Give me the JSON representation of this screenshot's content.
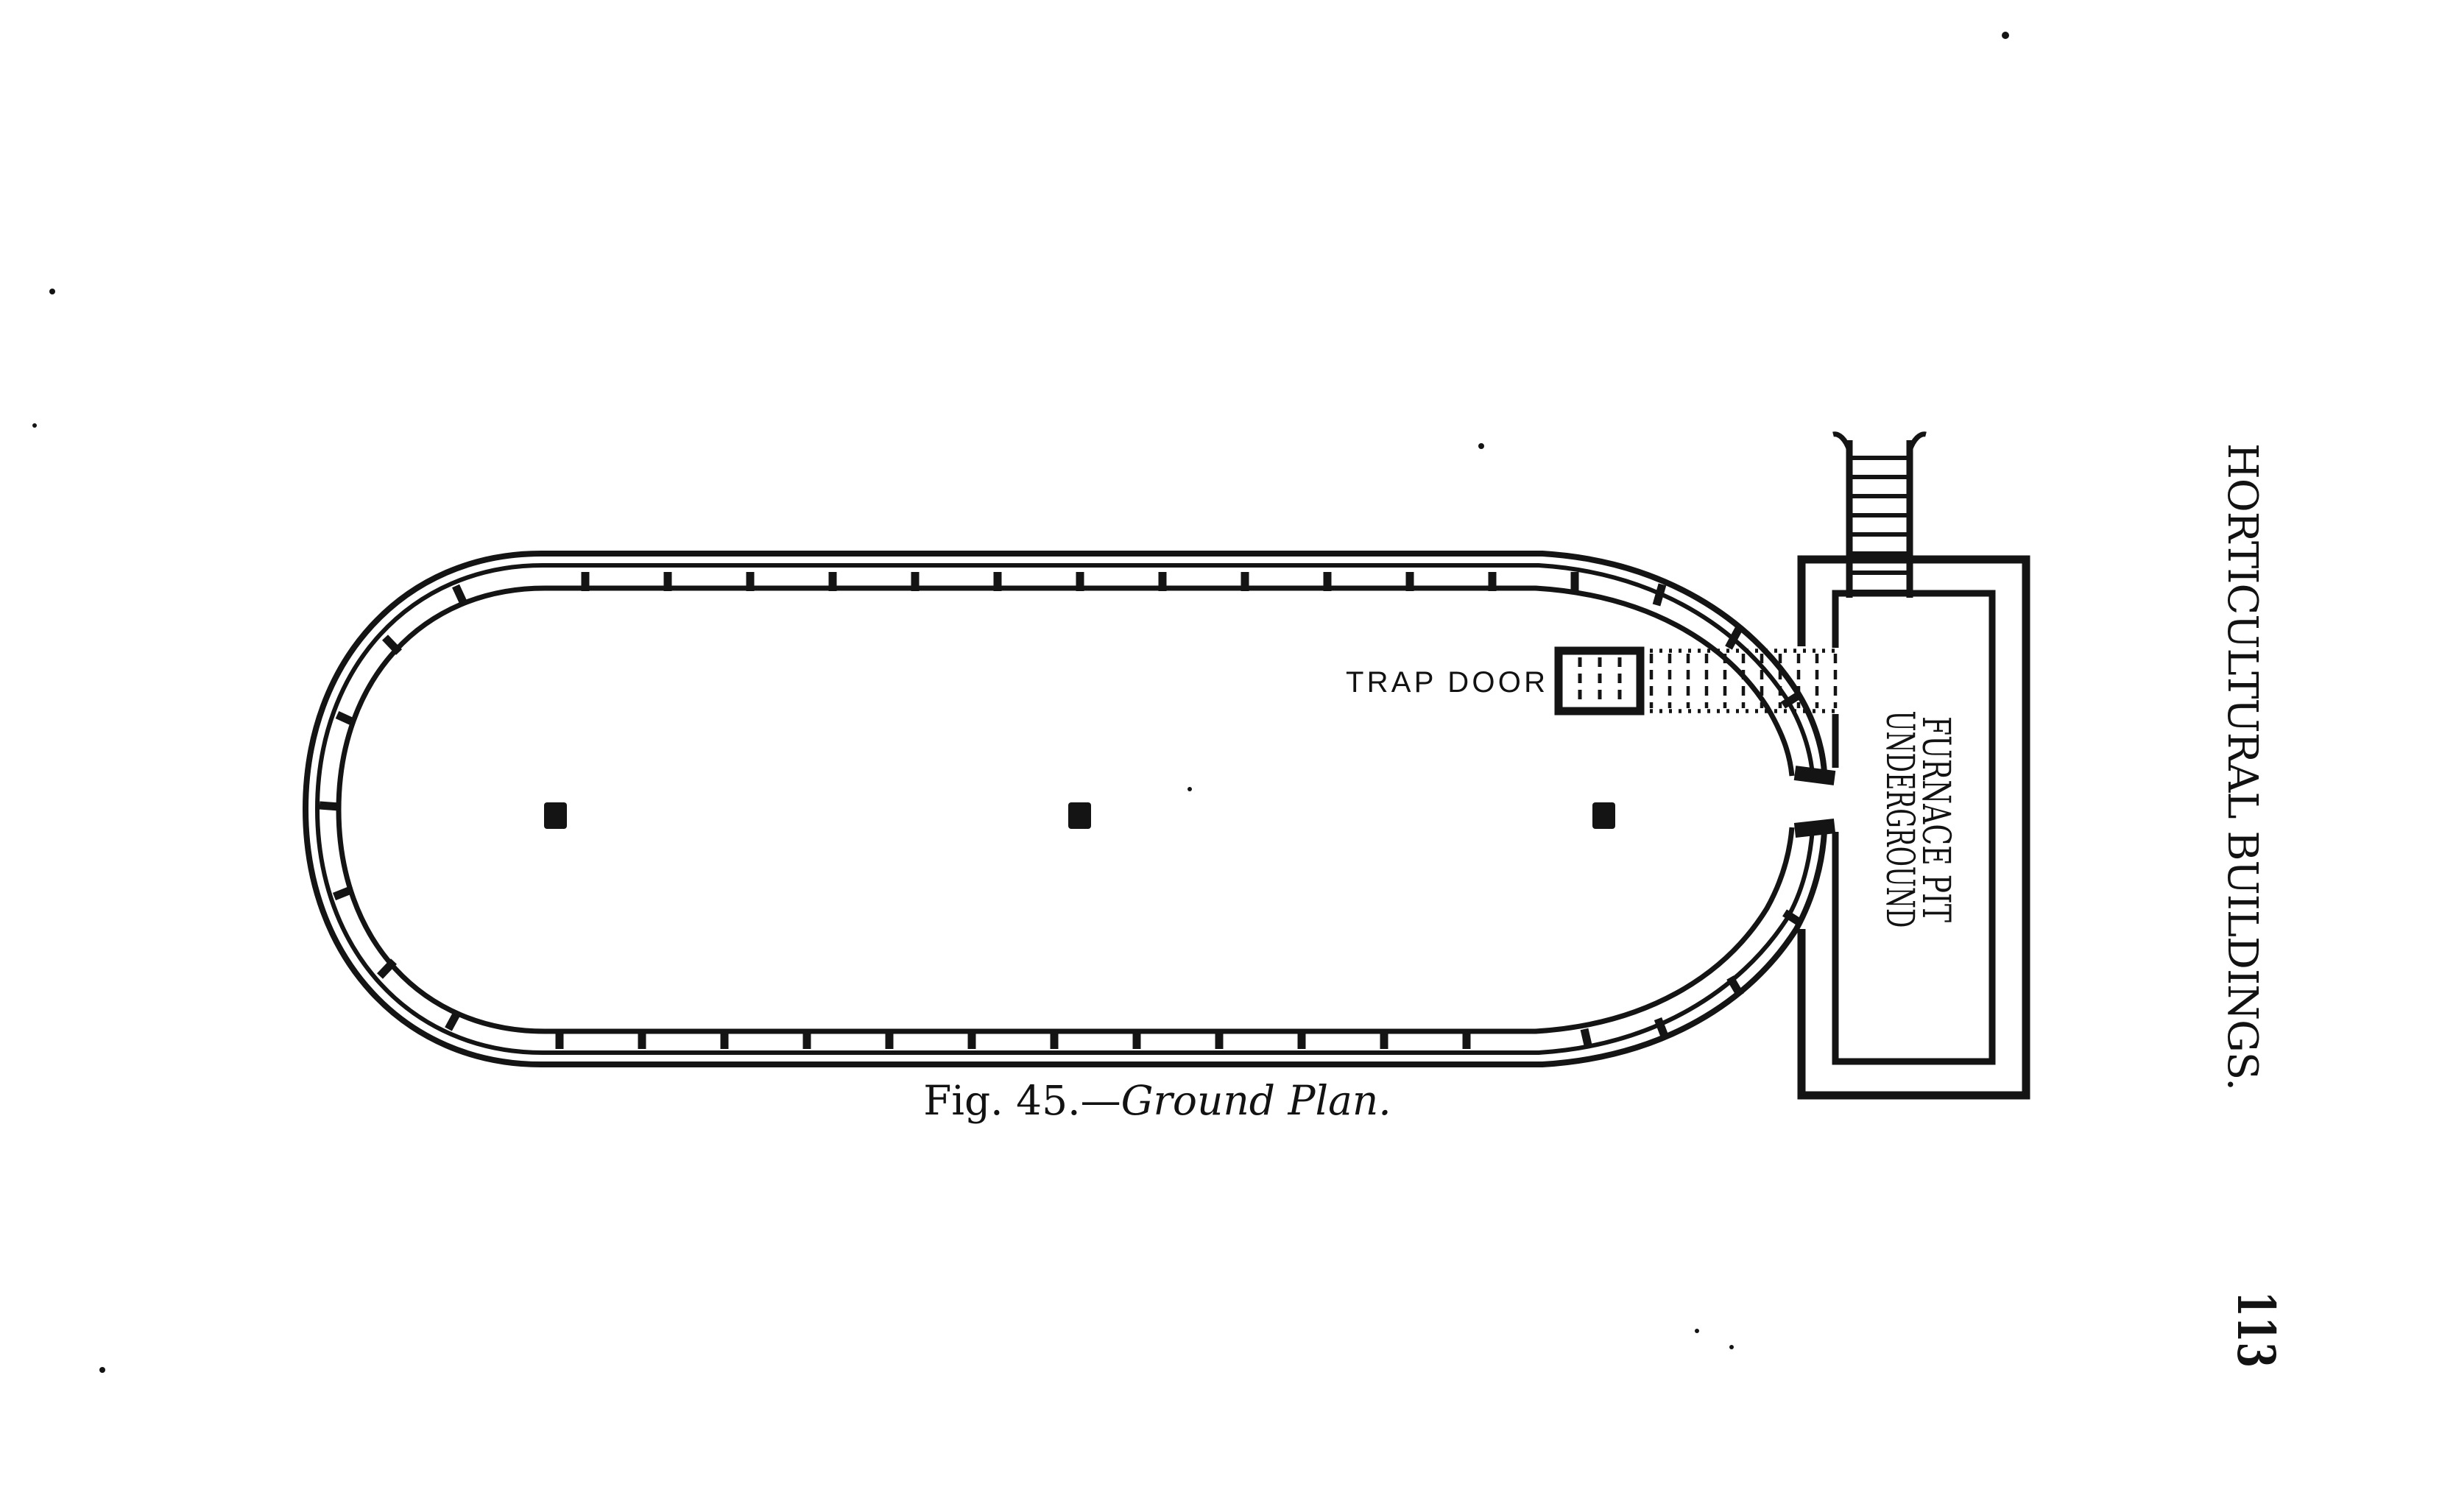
{
  "colors": {
    "paper": "#ffffff",
    "ink": "#141414"
  },
  "running_head": "HORTICULTURAL BUILDINGS.",
  "page_number": "113",
  "caption": {
    "figure_label": "Fig. 45.—",
    "figure_title": "Ground Plan."
  },
  "plan": {
    "trap_door_label": "TRAP DOOR",
    "furnace_label_line1": "FURNACE PIT",
    "furnace_label_line2": "UNDERGROUND"
  }
}
